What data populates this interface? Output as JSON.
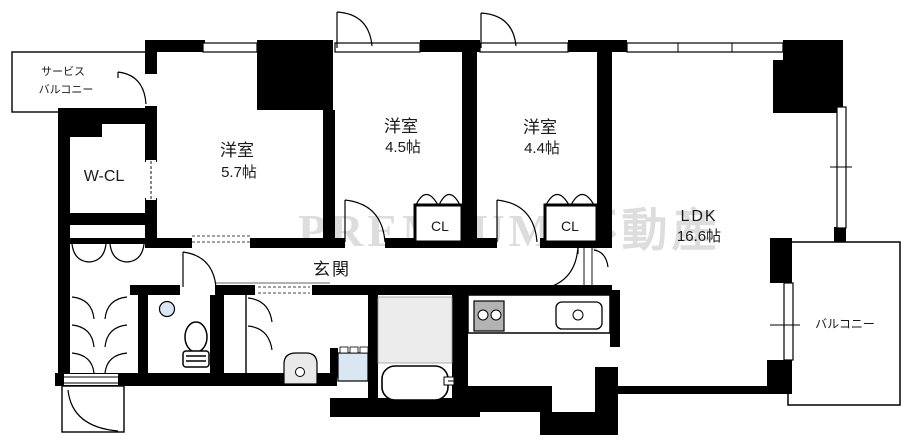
{
  "plan": {
    "rooms": {
      "service_balcony": {
        "line1": "サービス",
        "line2": "バルコニー"
      },
      "walk_in_closet": {
        "label": "W-CL"
      },
      "bedroom_57": {
        "name": "洋室",
        "size": "5.7帖"
      },
      "bedroom_45": {
        "name": "洋室",
        "size": "4.5帖"
      },
      "bedroom_44": {
        "name": "洋室",
        "size": "4.4帖"
      },
      "ldk": {
        "name": "LDK",
        "size": "16.6帖"
      },
      "closet_a": {
        "label": "CL"
      },
      "closet_b": {
        "label": "CL"
      },
      "entrance": {
        "label": "玄関"
      },
      "balcony": {
        "label": "バルコニー"
      }
    },
    "watermark": {
      "text": "PREMIUM 不動産"
    },
    "colors": {
      "wall": "#000000",
      "floor": "#ffffff",
      "bath_floor": "#ececec",
      "appliance_blue": "#d9e7f3",
      "stove_gray": "#b3b3b3",
      "vanity_gray": "#e9e9e9"
    }
  }
}
